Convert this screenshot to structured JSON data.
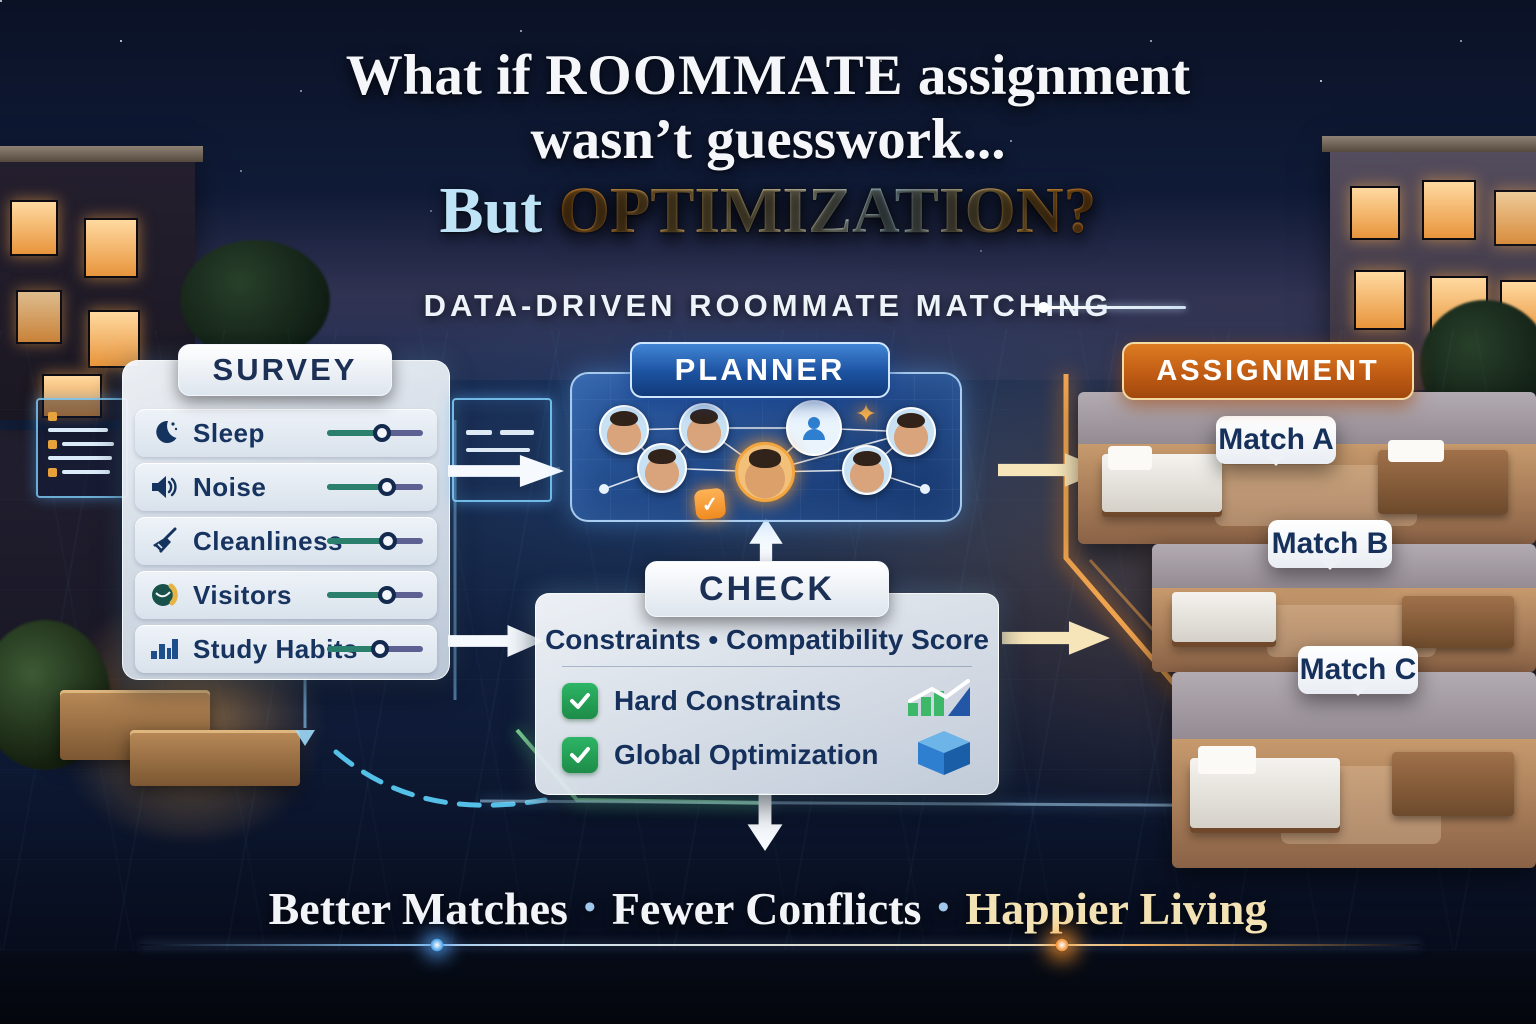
{
  "title": {
    "line1_pre": "What if ",
    "line1_em": "ROOMMATE",
    "line1_post": " assignment",
    "line2": "wasn’t guesswork...",
    "line3_pre": "But ",
    "line3_em": "OPTIMIZATION?"
  },
  "subtitle": "DATA-DRIVEN ROOMMATE MATCHING",
  "survey": {
    "header": "SURVEY",
    "items": [
      {
        "label": "Sleep",
        "icon": "moon-icon",
        "slider_percent": 57
      },
      {
        "label": "Noise",
        "icon": "speaker-icon",
        "slider_percent": 63
      },
      {
        "label": "Cleanliness",
        "icon": "broom-icon",
        "slider_percent": 64
      },
      {
        "label": "Visitors",
        "icon": "visitors-icon",
        "slider_percent": 62
      },
      {
        "label": "Study Habits",
        "icon": "bar-chart-icon",
        "slider_percent": 55
      }
    ]
  },
  "planner": {
    "header": "PLANNER",
    "node_count": 7,
    "center_badge": "check",
    "sparkle_glyph": "✦"
  },
  "check": {
    "header": "CHECK",
    "subheader": "Constraints • Compatibility Score",
    "items": [
      {
        "label": "Hard Constraints",
        "checked": true,
        "icon": "growth-chart-icon"
      },
      {
        "label": "Global Optimization",
        "checked": true,
        "icon": "cube-icon"
      }
    ]
  },
  "assignment": {
    "header": "ASSIGNMENT",
    "matches": [
      {
        "label": "Match A"
      },
      {
        "label": "Match B"
      },
      {
        "label": "Match C"
      }
    ]
  },
  "tagline": {
    "items": [
      "Better Matches",
      "Fewer Conflicts",
      "Happier Living"
    ],
    "separator": "•"
  },
  "colors": {
    "accent_blue": "#3d7fd4",
    "accent_orange": "#d8781f",
    "check_green": "#27a35a",
    "slider_green": "#2a7f6d",
    "slider_purple": "#5c6191",
    "navy_text": "#16305c",
    "gold_text": "#f3e3b4"
  }
}
